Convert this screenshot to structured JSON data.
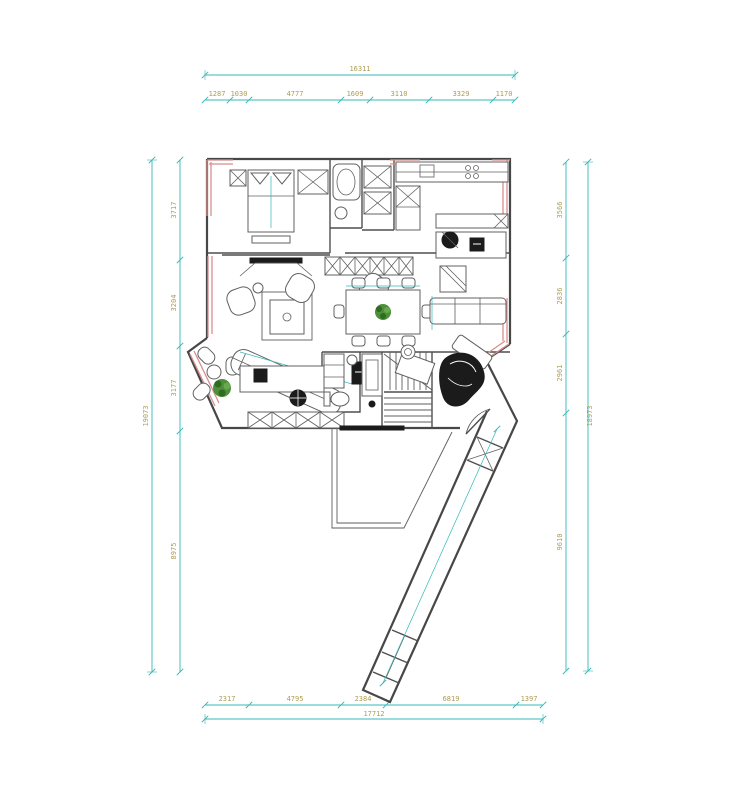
{
  "drawing": {
    "type": "architectural-floor-plan",
    "units": "mm",
    "description": "CAD floor plan with furniture layout, teal dimension chains on all four sides and red highlighted wall segments"
  },
  "colors": {
    "dimension_line": "#35b8b8",
    "dimension_text": "#ad9c55",
    "wall": "#474747",
    "highlight_wall": "#d88f8f",
    "plant": "#4e8f3a",
    "furniture_dark": "#1b1b1b",
    "background": "#ffffff"
  },
  "dims": {
    "top": {
      "total": "16311",
      "segments": [
        "1287",
        "1030",
        "4777",
        "1609",
        "3110",
        "3329",
        "1170"
      ]
    },
    "bottom": {
      "total": "17712",
      "segments": [
        "2317",
        "4795",
        "2384",
        "6819",
        "1397"
      ]
    },
    "left": {
      "total": "19073",
      "segments": [
        "3717",
        "3204",
        "3177",
        "8975"
      ]
    },
    "right": {
      "total": "18973",
      "segments": [
        "3566",
        "2836",
        "2961",
        "9610"
      ]
    }
  }
}
